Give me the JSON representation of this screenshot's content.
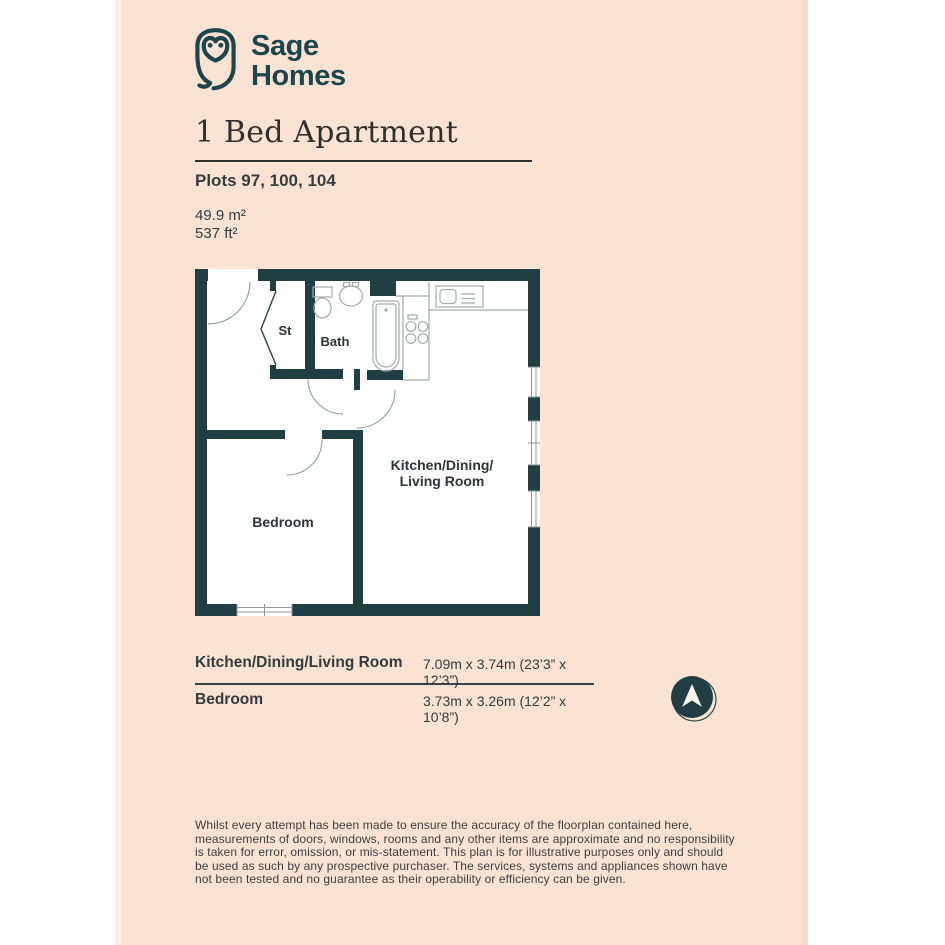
{
  "page": {
    "background_color": "#fbe3d3",
    "accent_color": "#203e44"
  },
  "logo": {
    "icon": "owl-logo-icon",
    "line1": "Sage",
    "line2": "Homes"
  },
  "header": {
    "title": "1 Bed Apartment",
    "plots": "Plots 97, 100, 104",
    "area_m2": "49.9 m²",
    "area_ft2": "537 ft²"
  },
  "floorplan": {
    "labels": {
      "storage": "St",
      "bath": "Bath",
      "bedroom": "Bedroom",
      "kitchen_line1": "Kitchen/Dining/",
      "kitchen_line2": "Living Room"
    }
  },
  "dimensions_table": {
    "rows": [
      {
        "room": "Kitchen/Dining/Living Room",
        "size": "7.09m x 3.74m (23’3” x 12’3”)"
      },
      {
        "room": "Bedroom",
        "size": "3.73m x 3.26m (12’2” x 10’8”)"
      }
    ]
  },
  "compass": {
    "icon": "north-arrow-icon"
  },
  "disclaimer": "Whilst every attempt has been made to ensure the accuracy of the floorplan contained here, measurements of doors, windows, rooms and any other items are approximate and no responsibility is taken for error, omission, or mis-statement. This plan is for illustrative purposes only and should be used as such by any prospective purchaser. The services, systems and appliances shown have not been tested and no guarantee as their operability or efficiency can be given."
}
